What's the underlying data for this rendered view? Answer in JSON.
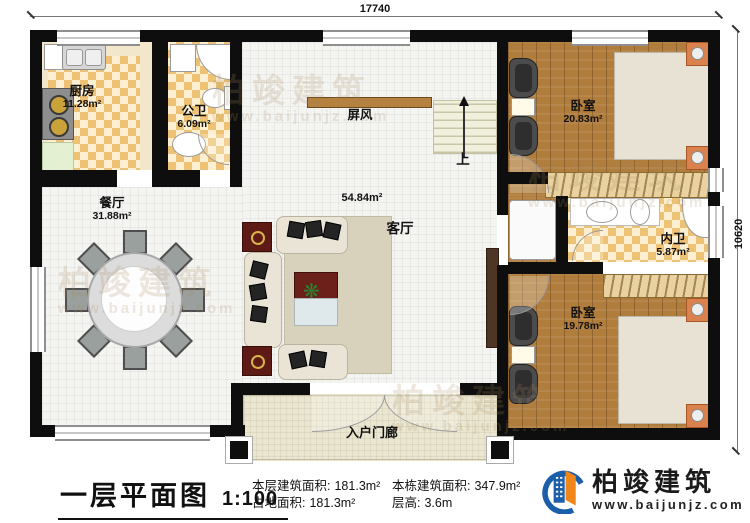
{
  "dimensions": {
    "top": "17740",
    "right": "10620"
  },
  "rooms": {
    "kitchen": {
      "name": "厨房",
      "area": "11.28m²"
    },
    "public_bath": {
      "name": "公卫",
      "area": "6.09m²"
    },
    "dining": {
      "name": "餐厅",
      "area": "31.88m²"
    },
    "living": {
      "name": "客厅",
      "area": "54.84m²"
    },
    "screen": {
      "name": "屏风"
    },
    "stairs": {
      "label": "上"
    },
    "bedroom_top": {
      "name": "卧室",
      "area": "20.83m²"
    },
    "ensuite_bath": {
      "name": "内卫",
      "area": "5.87m²"
    },
    "bedroom_bottom": {
      "name": "卧室",
      "area": "19.78m²"
    },
    "porch": {
      "name": "入户门廊"
    }
  },
  "title_block": {
    "title": "一层平面图",
    "scale": "1:100",
    "stats": [
      {
        "label": "本层建筑面积:",
        "value": "181.3m²"
      },
      {
        "label": "占地面积:",
        "value": "181.3m²"
      },
      {
        "label": "本栋建筑面积:",
        "value": "347.9m²"
      },
      {
        "label": "层高:",
        "value": "3.6m"
      }
    ]
  },
  "brand": {
    "name": "柏竣建筑",
    "url": "www.baijunjz.com"
  },
  "watermark": {
    "line1": "柏竣建筑",
    "line2": "www.baijunjz.com"
  },
  "colors": {
    "wall": "#0e0e0e",
    "tile_accent": "#eec274",
    "wood": "#b07d3c",
    "bed": "#74c5dc",
    "brand_blue": "#1a5fa8",
    "brand_orange": "#f08519"
  }
}
